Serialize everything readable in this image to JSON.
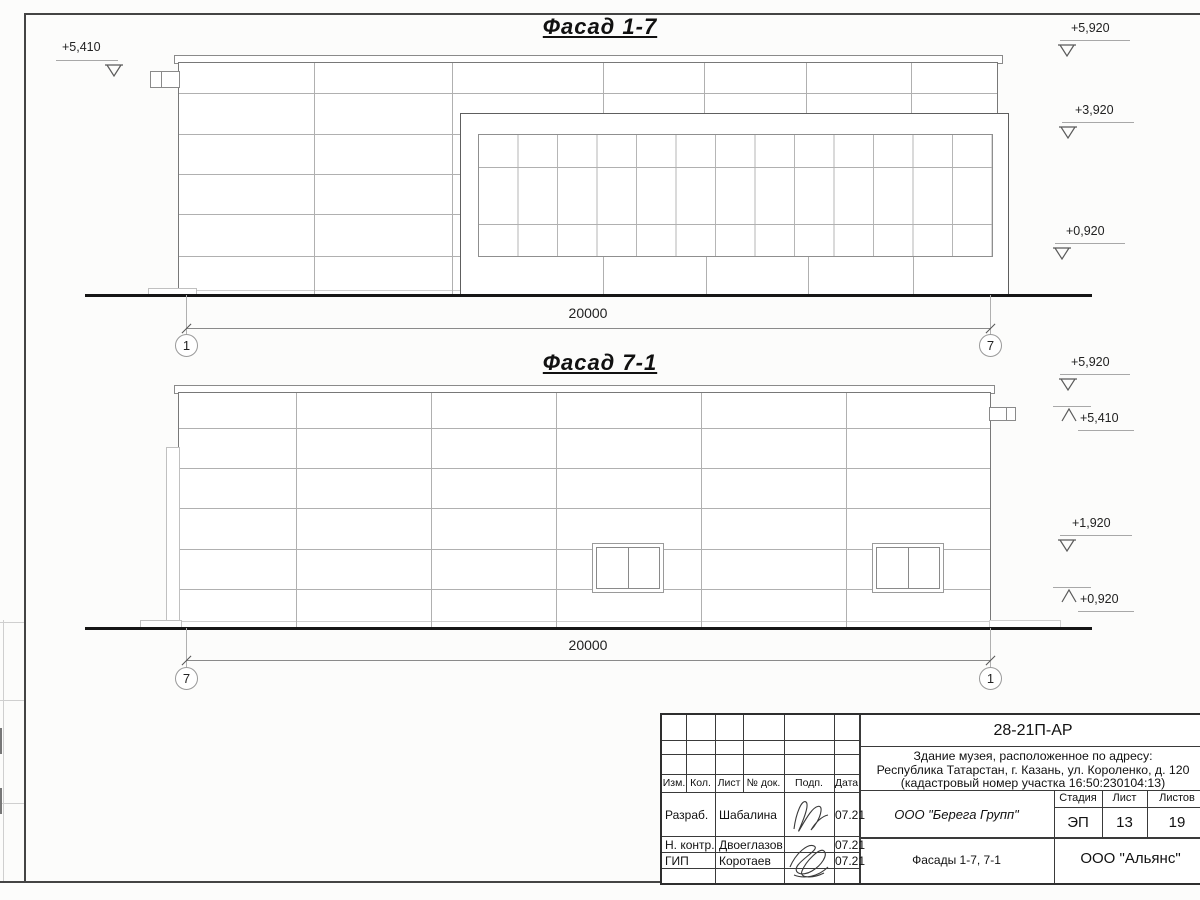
{
  "colors": {
    "ink": "#1c1c1c",
    "outline_gray": "#787878",
    "panel_line_gray": "#b0b0b0",
    "ground_black": "#161616",
    "paper": "#fcfcfb"
  },
  "facades": {
    "top": {
      "title": "Фасад 1-7",
      "dim_label": "20000",
      "axis_left": "1",
      "axis_right": "7",
      "elev_left": "+5,410",
      "elev_right": [
        "+5,920",
        "+3,920",
        "+0,920"
      ]
    },
    "bottom": {
      "title": "Фасад 7-1",
      "dim_label": "20000",
      "axis_left": "7",
      "axis_right": "1",
      "elev_right": [
        "+5,920",
        "+5,410",
        "+1,920",
        "+0,920"
      ]
    }
  },
  "title_block": {
    "doc_number": "28-21П-АР",
    "project_line1": "Здание музея, расположенное по адресу:",
    "project_line2": "Республика Татарстан, г. Казань, ул. Короленко, д. 120",
    "project_line3": "(кадастровый номер участка 16:50:230104:13)",
    "cols": {
      "izm": "Изм.",
      "kol": "Кол.",
      "list": "Лист",
      "doc": "№ док.",
      "podp": "Подп.",
      "data": "Дата"
    },
    "rows": {
      "dev_role": "Разраб.",
      "dev_name": "Шабалина",
      "dev_date": "07.21",
      "ncontr_role": "Н. контр.",
      "ncontr_name": "Двоеглазов",
      "ncontr_date": "07.21",
      "gip_role": "ГИП",
      "gip_name": "Коротаев",
      "gip_date": "07.21"
    },
    "company": "ООО \"Берега Групп\"",
    "stage_label": "Стадия",
    "sheet_label": "Лист",
    "sheets_label": "Листов",
    "stage": "ЭП",
    "sheet_no": "13",
    "sheets_total": "19",
    "drawing_title": "Фасады 1-7, 7-1",
    "org": "ООО \"Альянс\""
  }
}
